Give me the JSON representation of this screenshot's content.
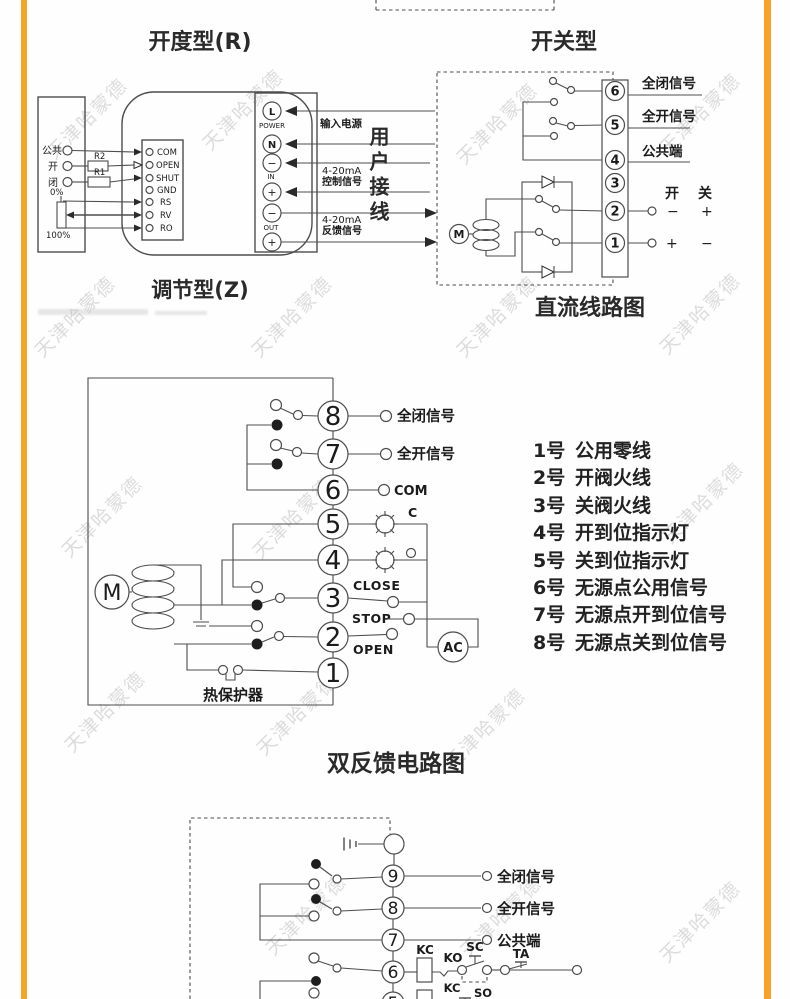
{
  "watermark": {
    "text": "天津哈蒙德"
  },
  "colors": {
    "accent": "#F7A327",
    "line": "#4d4d4d"
  },
  "section_r": {
    "title": "开度型(R)",
    "caption": "调节型(Z)",
    "left_terminals": [
      "公共",
      "开",
      "闭"
    ],
    "resistor_top": "R2",
    "resistor_bottom": "R1",
    "pot_top": "0%",
    "pot_bottom": "100%",
    "block_terminals": [
      "COM",
      "OPEN",
      "SHUT",
      "GND",
      "RS",
      "RV",
      "RO"
    ],
    "power_terminals": [
      "L",
      "N",
      "−",
      "+",
      "−",
      "+"
    ],
    "power_group_labels": [
      "POWER",
      "IN",
      "OUT"
    ],
    "arrow_label_supply": "输入电源",
    "arrow_label_control": [
      "4-20mA",
      "控制信号"
    ],
    "arrow_label_feedback": [
      "4-20mA",
      "反馈信号"
    ],
    "user_wiring": "用户接线"
  },
  "section_dc": {
    "title": "开关型",
    "caption": "直流线路图",
    "terminals": [
      "6",
      "5",
      "4",
      "3",
      "2",
      "1"
    ],
    "signal_labels": [
      "全闭信号",
      "全开信号",
      "公共端"
    ],
    "col_open": "开",
    "col_close": "关",
    "row2_signs": [
      "−",
      "+"
    ],
    "row1_signs": [
      "+",
      "−"
    ],
    "motor": "M"
  },
  "section_feedback": {
    "caption": "双反馈电路图",
    "terminals": [
      "8",
      "7",
      "6",
      "5",
      "4",
      "3",
      "2",
      "1"
    ],
    "label_full_close": "全闭信号",
    "label_full_open": "全开信号",
    "label_com": "COM",
    "label_c": "C",
    "label_close": "CLOSE",
    "label_stop": "STOP",
    "label_open": "OPEN",
    "label_ac": "AC",
    "motor": "M",
    "thermal": "热保护器",
    "notes": [
      {
        "no": "1号",
        "text": "公用零线"
      },
      {
        "no": "2号",
        "text": "开阀火线"
      },
      {
        "no": "3号",
        "text": "关阀火线"
      },
      {
        "no": "4号",
        "text": "开到位指示灯"
      },
      {
        "no": "5号",
        "text": "关到位指示灯"
      },
      {
        "no": "6号",
        "text": "无源点公用信号"
      },
      {
        "no": "7号",
        "text": "无源点开到位信号"
      },
      {
        "no": "8号",
        "text": "无源点关到位信号"
      }
    ]
  },
  "section_bottom": {
    "terminals": [
      "9",
      "8",
      "7",
      "6",
      "5"
    ],
    "label_full_close": "全闭信号",
    "label_full_open": "全开信号",
    "label_common": "公共端",
    "relay_kc": "KC",
    "contact_ko": "KO",
    "contact_sc": "SC",
    "contact_ta": "TA",
    "contact_kc": "KC",
    "contact_so": "SO",
    "relay_kc2": "KC"
  }
}
